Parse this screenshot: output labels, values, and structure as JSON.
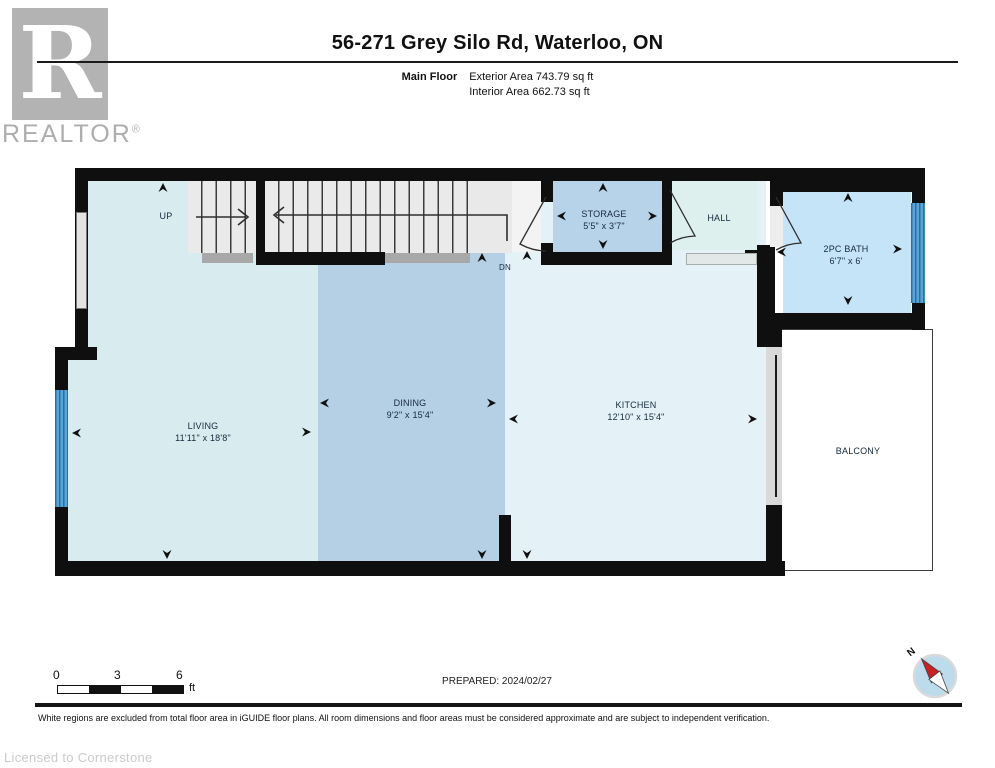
{
  "header": {
    "logo_letter": "R",
    "logo_text": "REALTOR",
    "logo_reg": "®",
    "title": "56-271 Grey Silo Rd, Waterloo, ON",
    "floor_label": "Main Floor",
    "exterior_area": "Exterior Area 743.79 sq ft",
    "interior_area": "Interior Area 662.73 sq ft"
  },
  "plan": {
    "rooms": {
      "living": {
        "name": "LIVING",
        "dims": "11'11\" x 18'8\""
      },
      "dining": {
        "name": "DINING",
        "dims": "9'2\" x 15'4\""
      },
      "kitchen": {
        "name": "KITCHEN",
        "dims": "12'10\" x 15'4\""
      },
      "storage": {
        "name": "STORAGE",
        "dims": "5'5\" x 3'7\""
      },
      "hall": {
        "name": "HALL"
      },
      "bath": {
        "name": "2PC BATH",
        "dims": "6'7\" x 6'"
      },
      "balcony": {
        "name": "BALCONY"
      }
    },
    "stairs": {
      "up_label": "UP",
      "down_label": "DN"
    }
  },
  "footer": {
    "scale": {
      "ticks": [
        "0",
        "3",
        "6"
      ],
      "unit": "ft"
    },
    "prepared": "PREPARED: 2024/02/27",
    "compass_north": "N",
    "disclaimer": "White regions are excluded from total floor area in iGUIDE floor plans. All room dimensions and floor areas must be considered approximate and are subject to independent verification.",
    "license": "Licensed to Cornerstone"
  },
  "colors": {
    "wall": "#0f0f0f",
    "living": "#d8ecef",
    "dining": "#b5cfe4",
    "kitchen": "#e4f2f8",
    "storage": "#b7d3e9",
    "hall": "#ddf0ee",
    "bath": "#c6e4f7",
    "stairs": "#eaeaea",
    "landing": "#a8a8a8",
    "window_blue": "#58a6d8",
    "compass_red": "#cc1f1f",
    "logo_gray": "#b3b3b3"
  }
}
